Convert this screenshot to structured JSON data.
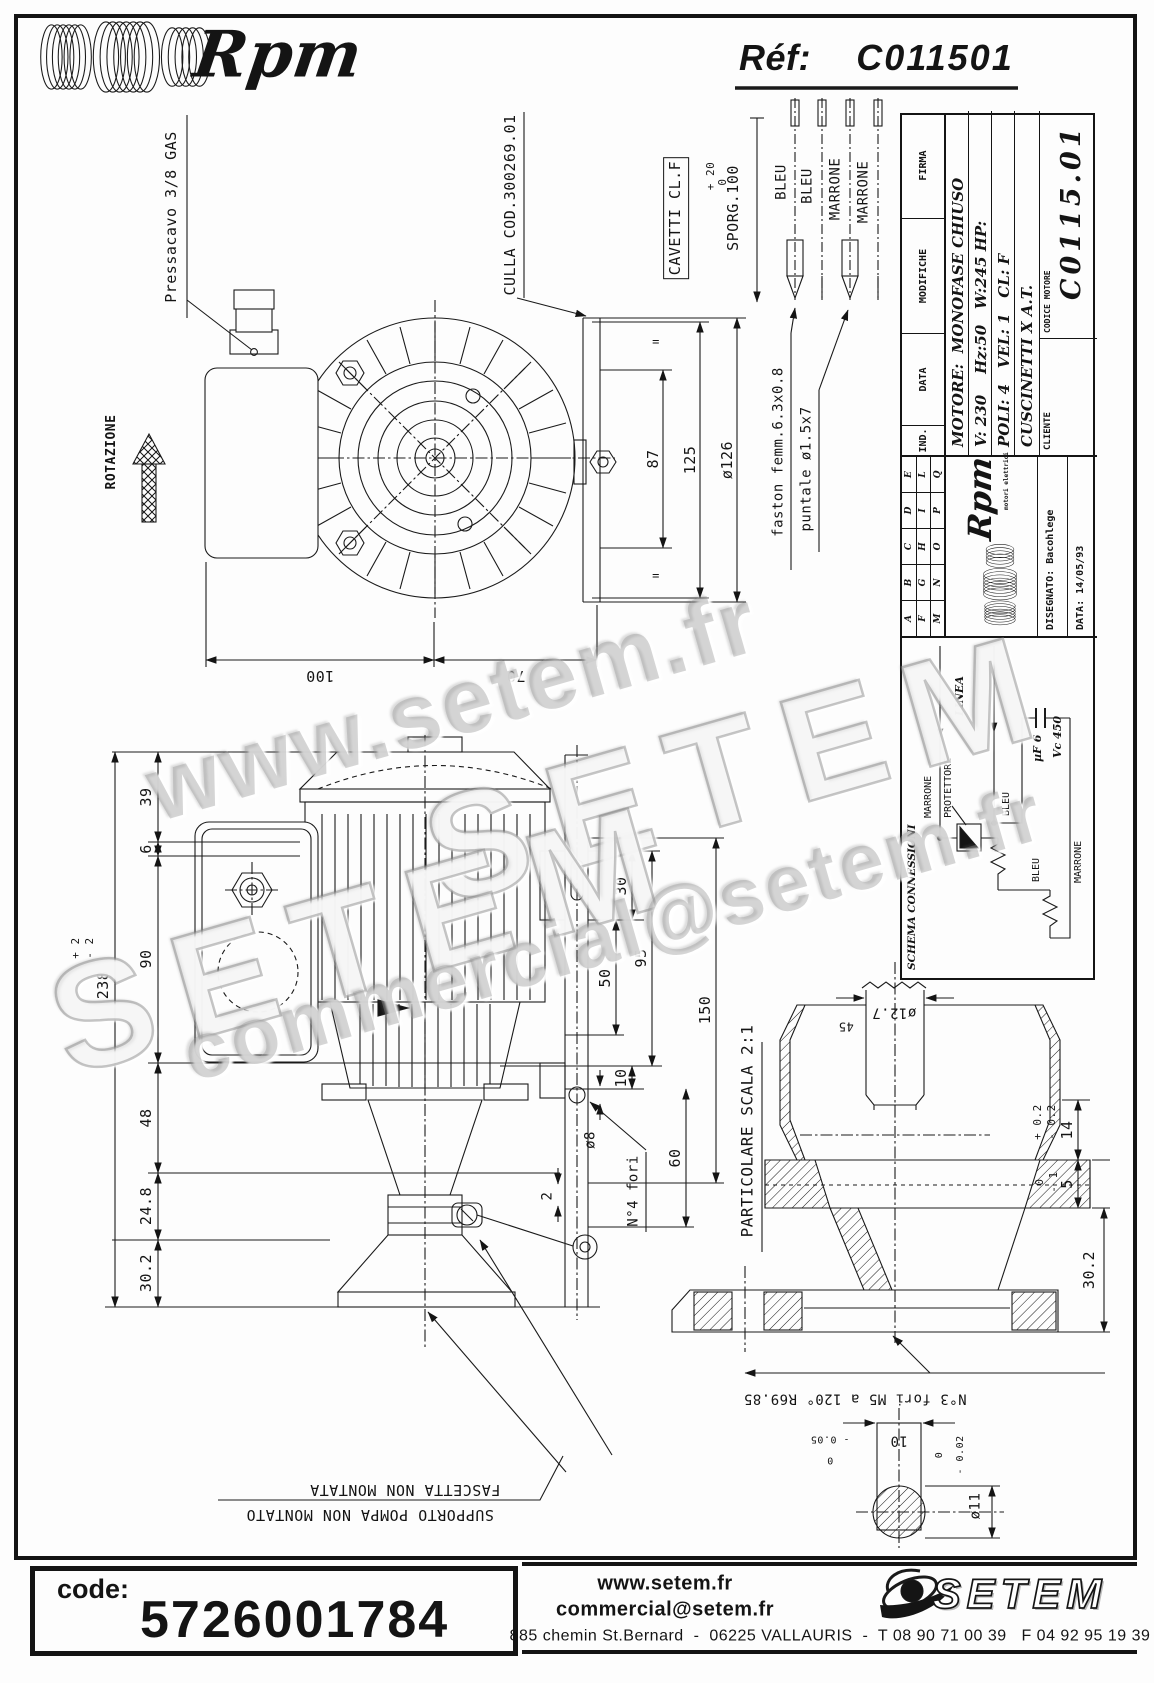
{
  "header": {
    "logo": "Rpm",
    "ref_label": "Réf:",
    "ref_value": "C011501"
  },
  "watermarks": {
    "w1": "www.setem.fr",
    "w2": "SETEM",
    "w3": "SETEM",
    "w4": "commercial@setem.fr"
  },
  "top_view": {
    "rotazione": "ROTAZIONE",
    "pressacavo": "Pressacavo 3/8 GAS",
    "culla": "CULLA COD.300269.01",
    "cavetti": "CAVETTI CL.F",
    "sporg": "SPORG.100",
    "sporg_plus": "+ 20",
    "sporg_zero": "0",
    "wire1": "BLEU",
    "wire2": "BLEU",
    "wire3": "MARRONE",
    "wire4": "MARRONE",
    "faston": "faston femm.6.3x0.8",
    "puntale": "puntale ø1.5x7",
    "dim100": "100",
    "dim70": "70",
    "dim87": "87",
    "dim125": "125",
    "dim126": "ø126",
    "eq": "="
  },
  "side_view": {
    "dim39": "39",
    "dim6": "6",
    "dim90": "90",
    "dim48": "48",
    "dim248": "24.8",
    "dim302": "30.2",
    "dim238": "238",
    "tol238_plus": "+ 2",
    "tol238_minus": "- 2",
    "dim30": "30",
    "dim50": "50",
    "dim95": "95",
    "dim150": "150",
    "dim10": "10",
    "dim60": "60",
    "dim_d8": "ø8",
    "dim2": "2",
    "fori4": "N°4 fori"
  },
  "detail": {
    "title": "PARTICOLARE SCALA 2:1",
    "d127": "ø12.7",
    "chamfer": "45",
    "dim14": "14",
    "tol14_plus": "+ 0.2",
    "tol14_minus": "- 0.2",
    "dim5": "5",
    "tol5_zero": "0",
    "tol5_minus": "- 1",
    "dim302": "30.2",
    "fori3": "N°3 fori M5 a 120° R69.85",
    "dim10": "10",
    "tol10_zero": "0",
    "tol10_minus": "- 0.05",
    "d11": "ø11",
    "tol11_zero": "0",
    "tol11_minus": "- 0.02"
  },
  "notes": {
    "fascetta": "FASCETTA NON MONTATA",
    "supporto": "SUPPORTO POMPA NON MONTATO"
  },
  "title_block": {
    "firma": "FIRMA",
    "modifiche": "MODIFICHE",
    "data": "DATA",
    "ind": "IND.",
    "letters": [
      "A",
      "B",
      "C",
      "D",
      "E",
      "F",
      "G",
      "H",
      "I",
      "L",
      "M",
      "N",
      "O",
      "P",
      "Q"
    ],
    "motore": "MOTORE:  MONOFASE CHIUSO",
    "riga2": "V: 230    Hz:50   W:245 HP:",
    "riga3": "POLI: 4   VEL: 1   CL: F",
    "riga4": "CUSCINETTI X A.T.",
    "cliente": "CLIENTE",
    "codice_label": "CODICE MOTORE",
    "codice": "C0115.01",
    "rpm": "Rpm",
    "rpm_sub": "motori elettrici",
    "disegnato": "DISEGNATO: Bacohlege",
    "data_value": "DATA: 14/05/93"
  },
  "schema": {
    "title": "SCHEMA CONNESSIONI",
    "linea": "LINEA",
    "marrone1": "MARRONE",
    "protettore": "PROTETTORE",
    "bleu1": "BLEU",
    "bleu2": "BLEU",
    "marrone2": "MARRONE",
    "uf": "µF 6",
    "vc": "Vc 450"
  },
  "footer": {
    "code_label": "code:",
    "code_value": "5726001784",
    "site": "www.setem.fr",
    "email": "commercial@setem.fr",
    "brand": "SETEM",
    "address": "885 chemin St.Bernard  -  06225 VALLAURIS  -  T 08 90 71 00 39   F 04 92 95 19 39"
  }
}
